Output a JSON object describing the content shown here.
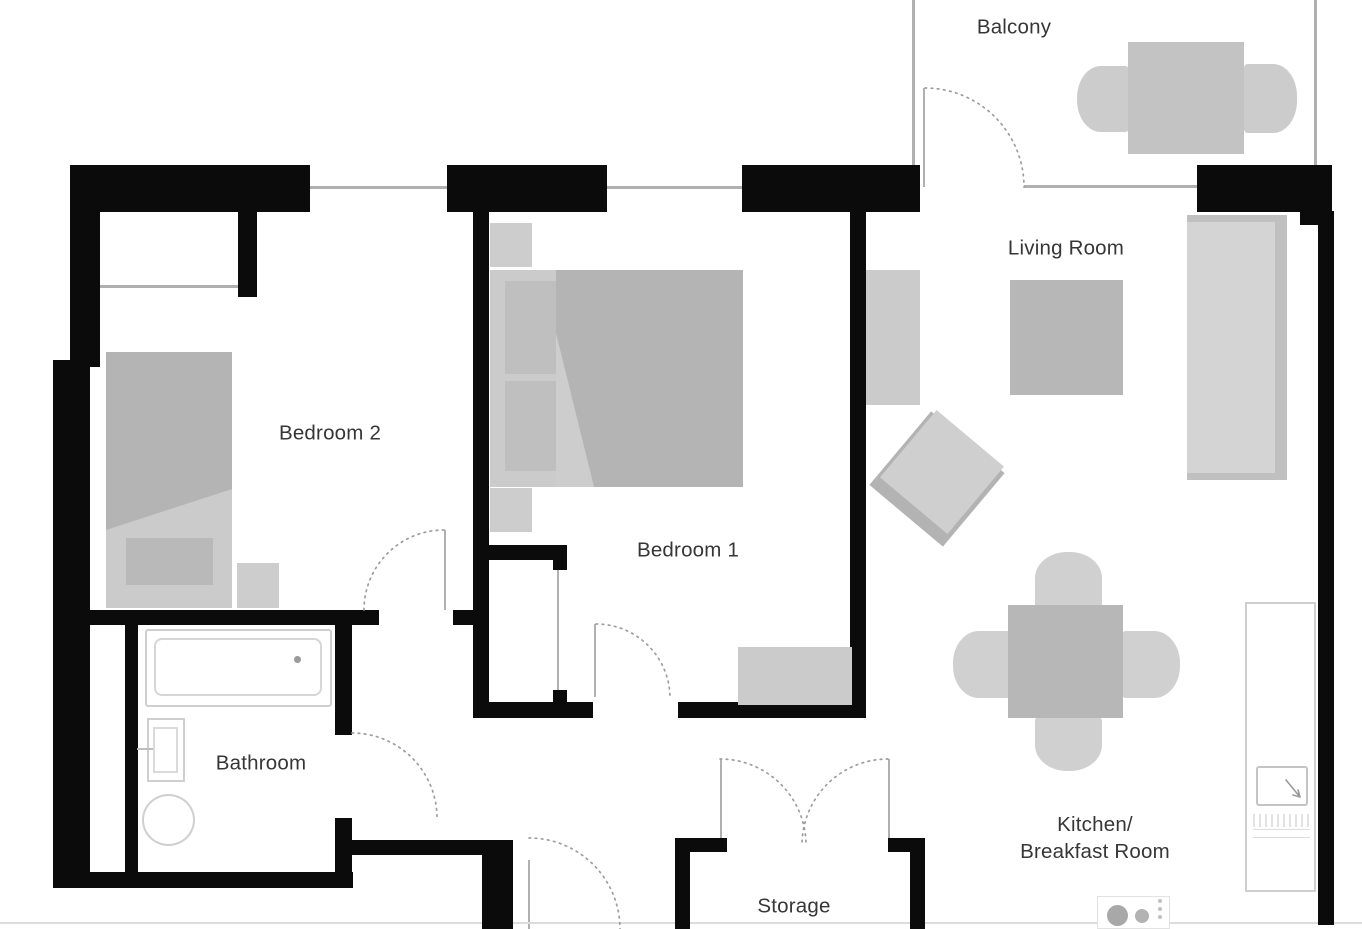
{
  "title": "Apartment floor plan",
  "labels": {
    "balcony": "Balcony",
    "living_room": "Living Room",
    "bedroom1": "Bedroom 1",
    "bedroom2": "Bedroom 2",
    "bathroom": "Bathroom",
    "storage": "Storage",
    "kitchen_line1": "Kitchen/",
    "kitchen_line2": "Breakfast Room"
  },
  "colors": {
    "wall": "#0b0b0b",
    "window_line": "#b0b0b0",
    "door_arc": "#9e9e9e",
    "furniture_light": "#cbcbcb",
    "furniture_medium": "#b4b4b4",
    "label_text": "#363636",
    "background": "#ffffff"
  }
}
